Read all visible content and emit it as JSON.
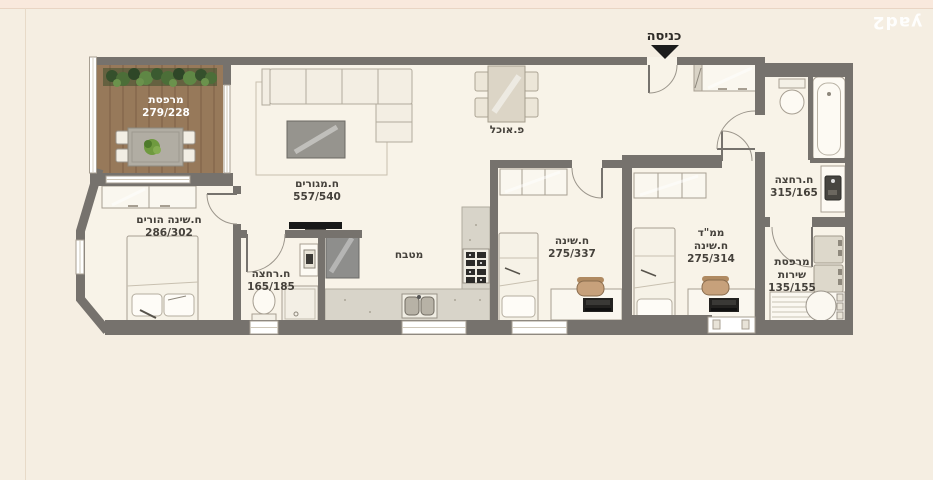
{
  "brand": {
    "logo_text": "yad2"
  },
  "entrance": {
    "label": "כניסה"
  },
  "rooms": {
    "balcony": {
      "name": "מרפסת",
      "dims": "279/228"
    },
    "living": {
      "name": "ח.מגורים",
      "dims": "557/540"
    },
    "dining": {
      "name": "פ.אוכל"
    },
    "parents_bedroom": {
      "name": "ח.שינה הורים",
      "dims": "286/302"
    },
    "bathroom_small": {
      "name": "ח.רחצה",
      "dims": "165/185"
    },
    "kitchen": {
      "name": "מטבח"
    },
    "bedroom": {
      "name": "ח.שינה",
      "dims": "275/337"
    },
    "mamad": {
      "name": "ממ\"ד",
      "name2": "ח.שינה",
      "dims": "275/314"
    },
    "bathroom_main": {
      "name": "ח.רחצה",
      "dims": "315/165"
    },
    "service_balcony": {
      "name": "מרפסת",
      "name2": "שירות",
      "dims": "135/155"
    }
  },
  "colors": {
    "background": "#f5eee2",
    "top_strip": "#f9e9dd",
    "wall": "#76726d",
    "floor": "#f8f3e8",
    "wood_deck": "#97795a",
    "plant_green": "#4c6e38",
    "counter": "#d8d4c9",
    "label_text": "#45413b",
    "brand_white": "#ffffff",
    "arrow_black": "#1c1c1c"
  }
}
